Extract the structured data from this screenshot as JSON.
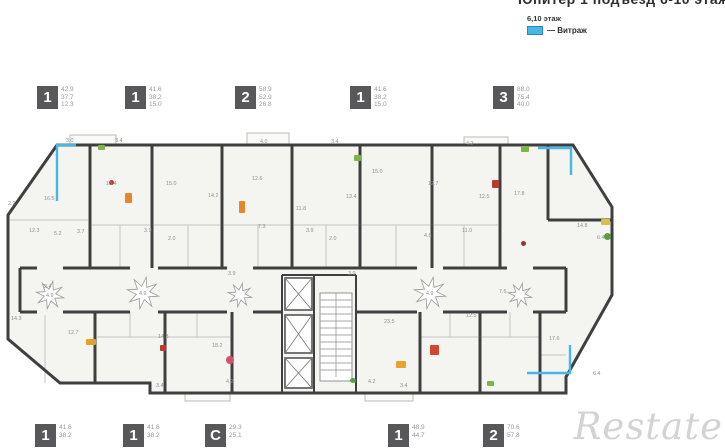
{
  "header": {
    "title": "Юпитер 1 подъезд 6-10 этаж",
    "legend_floors": "6,10 этаж",
    "legend_marker": "— Витраж",
    "vitrage_color": "#45b7e8"
  },
  "top_units": [
    {
      "type": "1",
      "areas": [
        "42.9",
        "37.7",
        "12.3"
      ]
    },
    {
      "type": "1",
      "areas": [
        "41.6",
        "38.2",
        "15.0"
      ]
    },
    {
      "type": "2",
      "areas": [
        "58.9",
        "52.9",
        "26.8"
      ]
    },
    {
      "type": "1",
      "areas": [
        "41.6",
        "38.2",
        "15.0"
      ]
    },
    {
      "type": "3",
      "areas": [
        "88.0",
        "75.4",
        "40.0"
      ]
    }
  ],
  "bottom_units": [
    {
      "type": "1",
      "areas": [
        "41.6",
        "38.2"
      ]
    },
    {
      "type": "1",
      "areas": [
        "41.6",
        "38.2"
      ]
    },
    {
      "type": "С",
      "areas": [
        "29.3",
        "25.1"
      ]
    },
    {
      "type": "1",
      "areas": [
        "48.9",
        "44.7"
      ]
    },
    {
      "type": "2",
      "areas": [
        "70.6",
        "57.8"
      ]
    }
  ],
  "watermark": "Restate",
  "plan": {
    "wall_color": "#3f3f3f",
    "room_fill": "#f4f4f1",
    "line_color": "#c5c5c3",
    "label_color": "#8f8f8f",
    "room_labels": [
      [
        66,
        17,
        "3.0"
      ],
      [
        115,
        17,
        "3.4"
      ],
      [
        260,
        18,
        "4.0"
      ],
      [
        331,
        18,
        "3.4"
      ],
      [
        466,
        20,
        "4.2"
      ],
      [
        44,
        75,
        "16.5"
      ],
      [
        106,
        60,
        "13.4"
      ],
      [
        166,
        60,
        "15.0"
      ],
      [
        208,
        72,
        "14.2"
      ],
      [
        252,
        55,
        "12.6"
      ],
      [
        258,
        103,
        "7.3"
      ],
      [
        296,
        85,
        "11.8"
      ],
      [
        346,
        73,
        "13.4"
      ],
      [
        372,
        48,
        "15.0"
      ],
      [
        428,
        60,
        "12.7"
      ],
      [
        479,
        73,
        "12.5"
      ],
      [
        514,
        70,
        "17.8"
      ],
      [
        8,
        80,
        "2.2"
      ],
      [
        29,
        107,
        "12.3"
      ],
      [
        54,
        110,
        "5.2"
      ],
      [
        77,
        108,
        "3.7"
      ],
      [
        144,
        107,
        "3.9"
      ],
      [
        168,
        115,
        "2.0"
      ],
      [
        306,
        107,
        "3.9"
      ],
      [
        329,
        115,
        "2.0"
      ],
      [
        424,
        112,
        "4.6"
      ],
      [
        462,
        107,
        "11.0"
      ],
      [
        577,
        102,
        "14.8"
      ],
      [
        597,
        114,
        "6.4"
      ],
      [
        44,
        163,
        "2.4"
      ],
      [
        46,
        172,
        "4.9"
      ],
      [
        139,
        170,
        "4.9"
      ],
      [
        228,
        150,
        "3.9"
      ],
      [
        348,
        150,
        "3.9"
      ],
      [
        426,
        170,
        "4.9"
      ],
      [
        499,
        168,
        "7.5"
      ],
      [
        11,
        195,
        "14.3"
      ],
      [
        68,
        209,
        "12.7"
      ],
      [
        158,
        213,
        "14.3"
      ],
      [
        212,
        222,
        "18.2"
      ],
      [
        226,
        258,
        "4.2"
      ],
      [
        384,
        198,
        "23.5"
      ],
      [
        466,
        192,
        "12.5"
      ],
      [
        549,
        215,
        "17.6"
      ],
      [
        593,
        250,
        "6.4"
      ],
      [
        368,
        258,
        "4.2"
      ],
      [
        400,
        262,
        "3.4"
      ],
      [
        156,
        262,
        "3.4"
      ]
    ],
    "furniture": [
      [
        98,
        20,
        7,
        5,
        "#7ab648",
        "r"
      ],
      [
        125,
        68,
        7,
        10,
        "#e8872a",
        "r"
      ],
      [
        239,
        76,
        6,
        12,
        "#e8872a",
        "r"
      ],
      [
        109,
        55,
        5,
        5,
        "#c0392b",
        "c"
      ],
      [
        354,
        30,
        7,
        6,
        "#7ab648",
        "r"
      ],
      [
        492,
        55,
        7,
        8,
        "#c0392b",
        "r"
      ],
      [
        521,
        21,
        8,
        6,
        "#7ab648",
        "r"
      ],
      [
        601,
        94,
        9,
        6,
        "#d4c24a",
        "r"
      ],
      [
        604,
        108,
        7,
        7,
        "#5d9e3c",
        "c"
      ],
      [
        86,
        214,
        10,
        6,
        "#e0a22e",
        "r"
      ],
      [
        226,
        231,
        8,
        8,
        "#d84f6e",
        "c"
      ],
      [
        396,
        236,
        10,
        7,
        "#e8a32a",
        "r"
      ],
      [
        430,
        220,
        9,
        10,
        "#d2452e",
        "r"
      ],
      [
        350,
        253,
        6,
        5,
        "#5d9e3c",
        "c"
      ],
      [
        487,
        256,
        7,
        5,
        "#7ab648",
        "r"
      ],
      [
        521,
        116,
        5,
        5,
        "#8e3b2e",
        "c"
      ],
      [
        160,
        220,
        6,
        6,
        "#c0392b",
        "r"
      ]
    ],
    "stars": [
      [
        50,
        170,
        14
      ],
      [
        143,
        168,
        16
      ],
      [
        240,
        170,
        12
      ],
      [
        430,
        168,
        16
      ],
      [
        520,
        170,
        12
      ]
    ],
    "vitrage": [
      "M76,20 L57,20 L57,76",
      "M538,23 L571,23 L571,50",
      "M570,220 L570,248 L527,248"
    ]
  }
}
